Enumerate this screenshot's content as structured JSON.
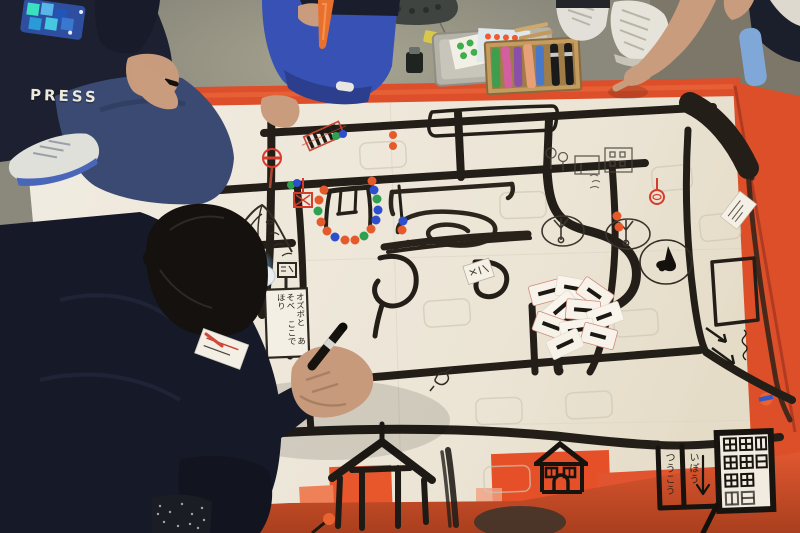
{
  "texts": {
    "press_sleeve": "PRESS",
    "one_way_word1": "つうこう",
    "one_way_word2": "いぽう",
    "ozobot_sign": "オズボと あそべ ここで ほり"
  },
  "palette": {
    "floor_concrete": "#8b897b",
    "floor_light_patch": "#a6a390",
    "floor_dark_corner": "#524a3c",
    "paper_white": "#f0ebe0",
    "tape_orange": "#dd4e2a",
    "tape_light": "#ea7c54",
    "road_black": "#231e18",
    "sticker_dot_orange": "#e55a2b",
    "sticker_dot_blue": "#2e4fcc",
    "sticker_dot_green": "#2ea04f",
    "red_marker_sign": "#d43c2c",
    "navy_clothing": "#161a28",
    "denim_blue": "#3a4a72",
    "kid_pants_blue": "#3752b4",
    "skin": "#c99c7e",
    "ozobot_glow_blue": "#5ec1ff",
    "marker_box_wood": "#c59c60",
    "marker_colors": [
      "#3f9e4d",
      "#d45fa0",
      "#8a4fa8",
      "#e8a078",
      "#4a78c8",
      "#1a1a1a",
      "#1a1a1a"
    ]
  },
  "objects": [
    "hand-drawn-town-map",
    "orange-tape-border",
    "ozobot-robot",
    "code-cards-pile",
    "marker-box",
    "sticker-tin",
    "ink-bottle",
    "crocs-shoe",
    "crosswalk-drawing",
    "swing-drawing",
    "dot-sticker-arc",
    "house-drawings",
    "apartment-building-drawing",
    "one-way-sign",
    "press-kid",
    "pointing-kid",
    "kneeling-kid",
    "foreground-girl"
  ]
}
